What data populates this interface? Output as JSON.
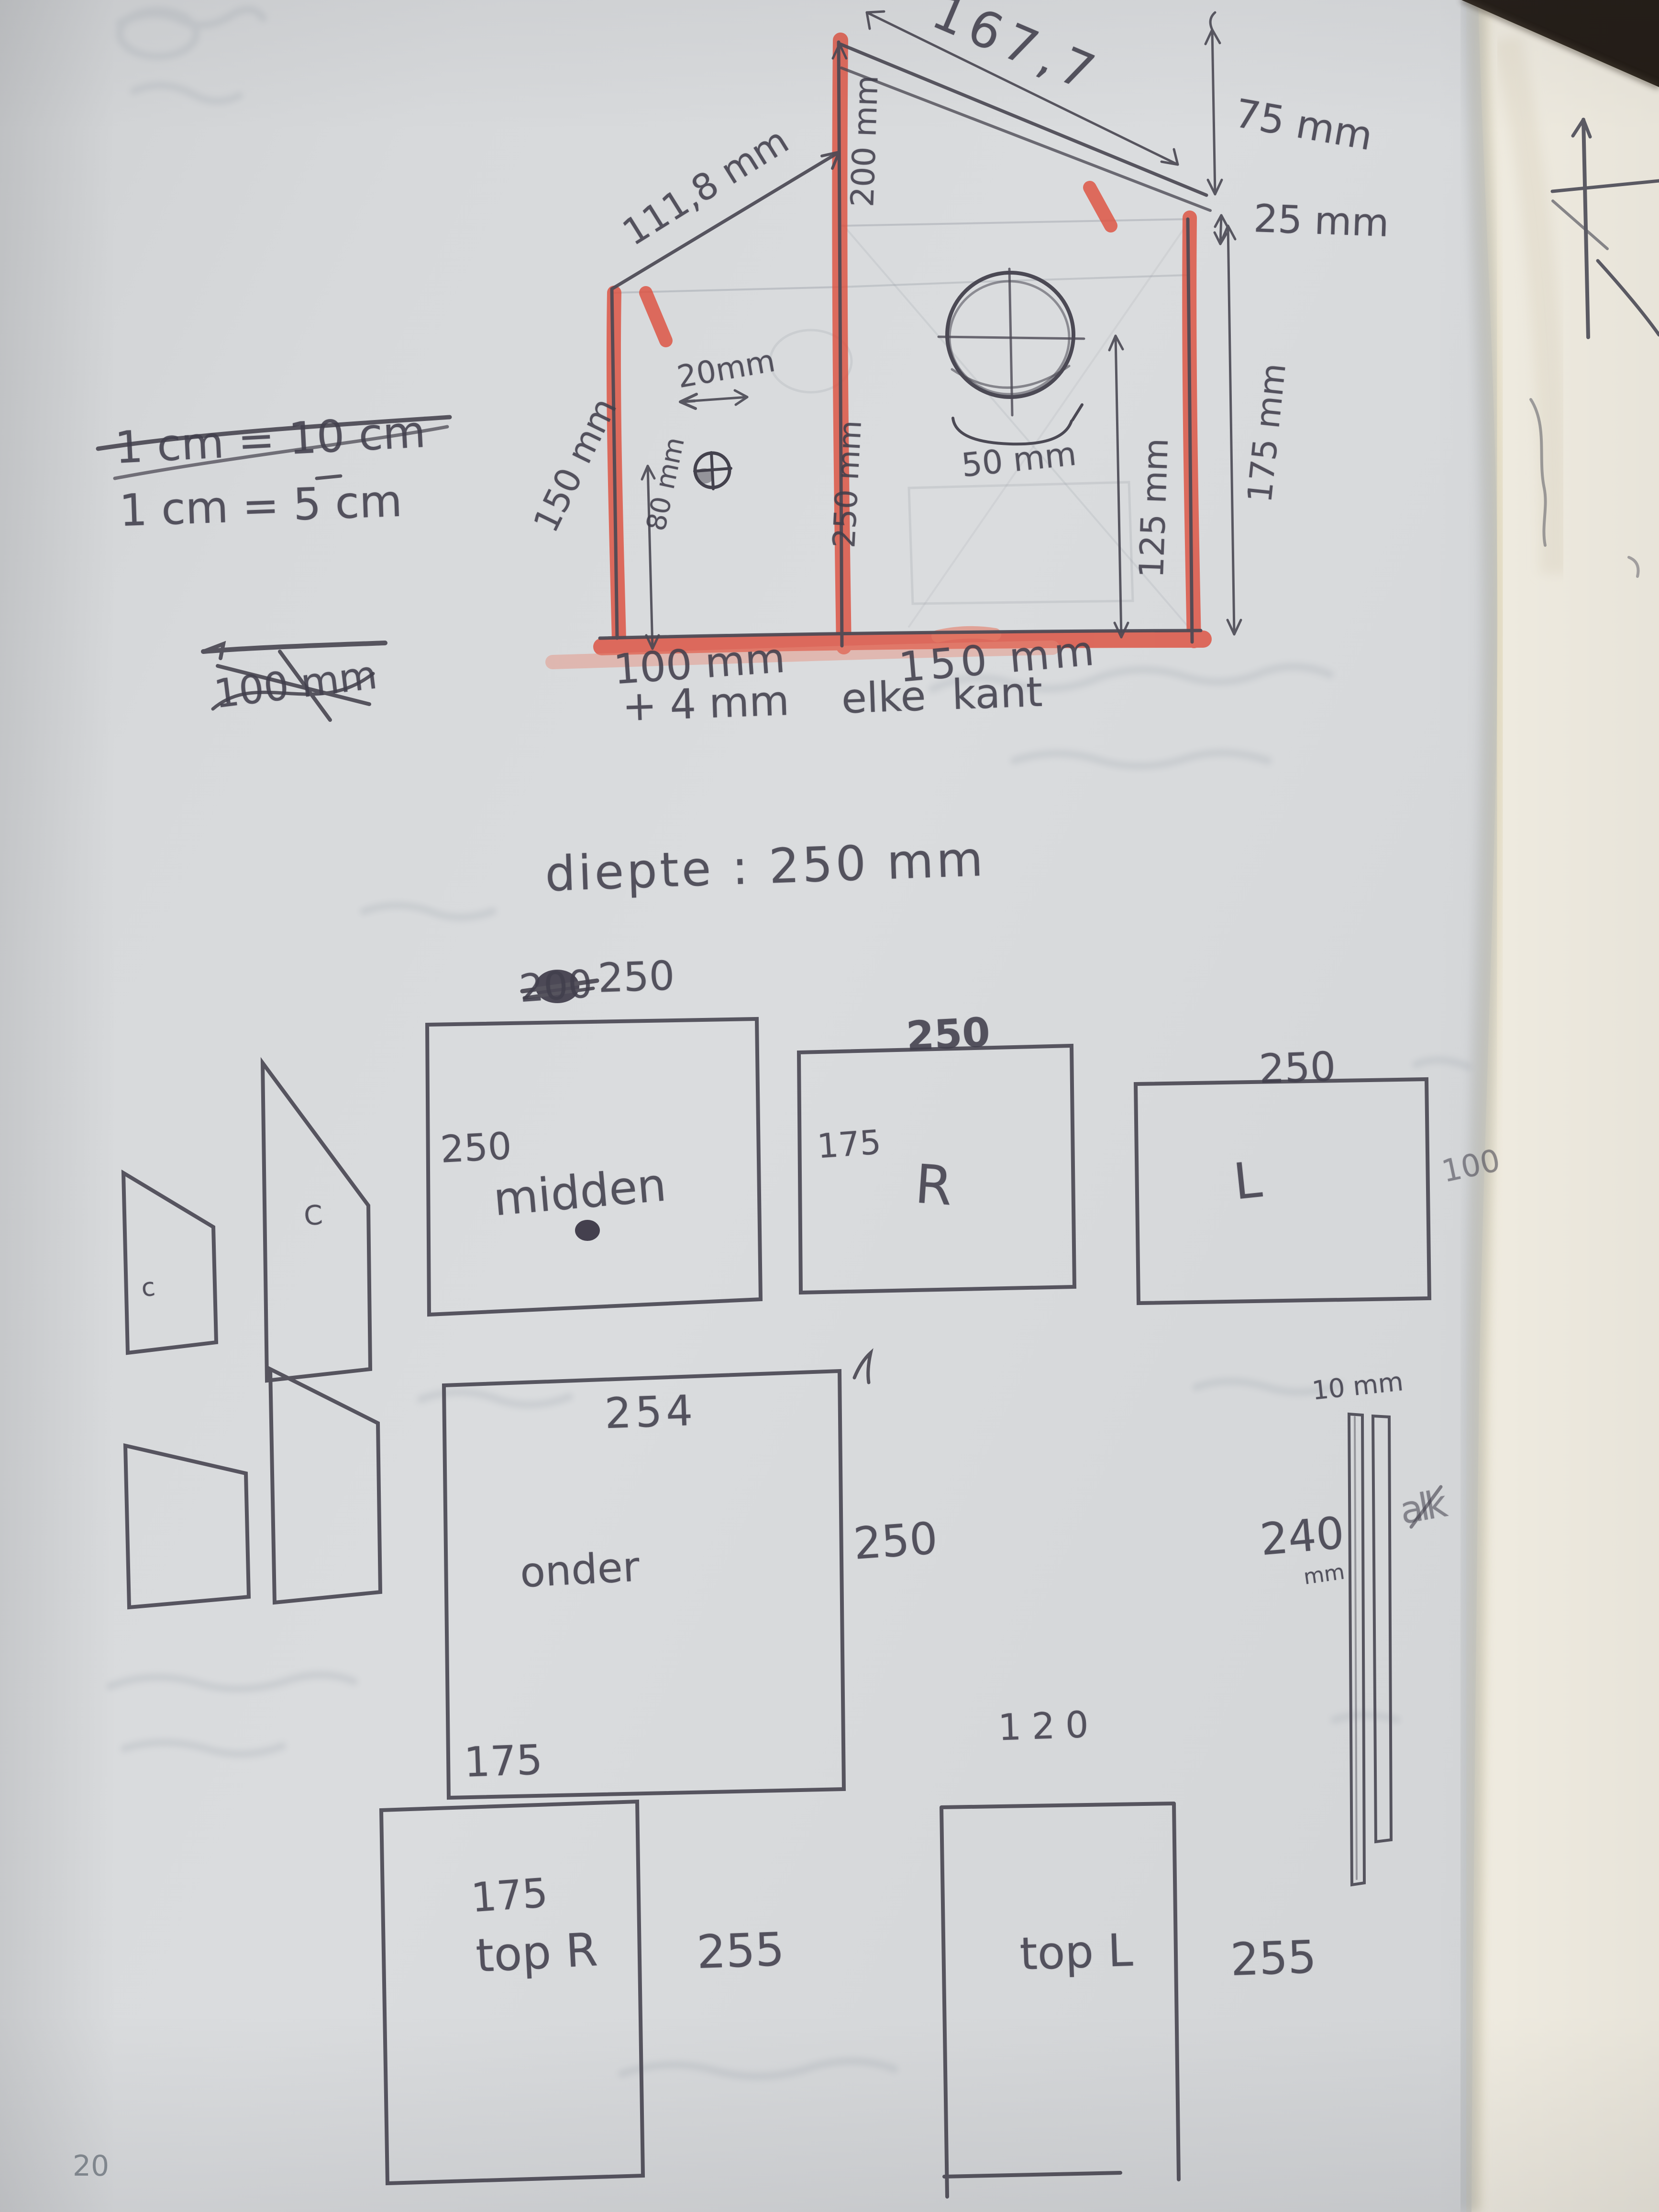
{
  "notes": {
    "scale_old": "1 cm = 10 cm",
    "scale_new": "1 cm = 5 cm",
    "crossed_out": "100 mm",
    "allowance": "+ 4 mm    elke  kant",
    "depth_title": "diepte : 250 mm"
  },
  "front_view": {
    "roof_left": "111,8 mm",
    "roof_right": "167,7",
    "overhang": "75 mm",
    "gap": "25 mm",
    "ridge": "200 mm",
    "divider": "250 mm",
    "left_wall": "150 mm",
    "left_inner": "80 mm",
    "screw_offset": "20mm",
    "hole_offset": "50 mm",
    "right_inner": "125 mm",
    "right_wall": "175 mm",
    "bottom_left": "100 mm",
    "bottom_right": "150 mm"
  },
  "parts": {
    "side_small_label": "c",
    "side_big_label": "C",
    "midden": {
      "name": "midden",
      "top_old": "200",
      "top": "250",
      "width": "250"
    },
    "r": {
      "name": "R",
      "top": "250",
      "height": "175"
    },
    "l": {
      "name": "L",
      "top": "250",
      "height": "100"
    },
    "onder": {
      "name": "onder",
      "top": "254",
      "height": "250",
      "below": "175"
    },
    "strips": {
      "width": "10 mm",
      "length": "240",
      "unit": "mm",
      "scribble": "alk"
    },
    "top_r": {
      "name": "top R",
      "top": "175",
      "height": "255"
    },
    "top_l": {
      "name": "top L",
      "top": "120",
      "height": "255"
    }
  },
  "page": {
    "number": "20"
  },
  "colors": {
    "marker": "#dd5140",
    "pencil": "#4b4954",
    "paper": "#d7d9db",
    "under_page": "#f1ede2"
  }
}
